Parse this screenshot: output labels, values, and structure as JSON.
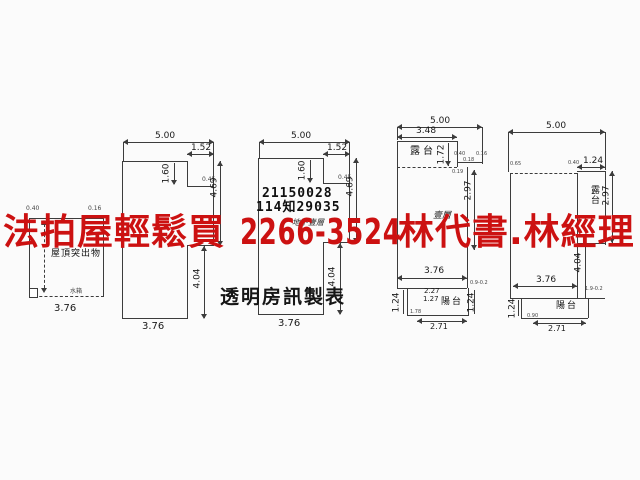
{
  "watermark": {
    "text_left": "法拍屋輕鬆買",
    "text_phone": "2266-3524",
    "text_right": "林代書.林經理",
    "color": "#cc1111"
  },
  "stamp": {
    "serial_1": "21150028",
    "serial_2": "114知29035",
    "publisher": "透明房訊製表"
  },
  "plans": {
    "p1": {
      "label": "屋頂突出物",
      "dim_bottom": "3.76",
      "tiny_top_left": "0.40",
      "tiny_top_right": "0.16",
      "tiny_bottom": "水箱"
    },
    "p2": {
      "dim_top": "5.00",
      "dim_step_w": "1.52",
      "dim_step_h": "1.60",
      "dim_right_upper": "4.69",
      "dim_right_lower": "4.04",
      "dim_bottom": "3.76",
      "tiny_step": "0.45"
    },
    "p3": {
      "floor_label": "地下壹層",
      "dim_top": "5.00",
      "dim_step_w": "1.52",
      "dim_step_h": "1.60",
      "dim_right_upper": "4.69",
      "dim_right_lower": "4.04",
      "dim_bottom": "3.76",
      "tiny_step": "0.45"
    },
    "p4": {
      "floor_label": "壹層",
      "terrace_label": "露台",
      "balcony_label": "陽台",
      "dim_top": "5.00",
      "dim_terrace_w": "3.48",
      "dim_terrace_h": "1.72",
      "dim_right": "2.97",
      "dim_width": "3.76",
      "dim_balcony_left": "1.24",
      "dim_balcony_right": "1.24",
      "dim_balcony_w1": "2.27",
      "dim_balcony_w2": "1.27",
      "dim_balcony_bottom": "2.71",
      "tiny_a": "0.40",
      "tiny_b": "0.18",
      "tiny_c": "0.16",
      "tiny_d": "0.19",
      "tiny_e": "1.78",
      "tiny_f": "0.9-0.2"
    },
    "p5": {
      "terrace_label": "露台",
      "balcony_label": "陽台",
      "dim_top": "5.00",
      "dim_terrace_w": "1.24",
      "dim_right": "2.97",
      "dim_right_lower": "4.04",
      "dim_width": "3.76",
      "dim_balcony_left": "1.24",
      "dim_balcony_bottom": "2.71",
      "tiny_top_left": "0.65",
      "tiny_top_right": "0.40",
      "tiny_bottom_left": "0.90",
      "tiny_bottom_right": "1.9-0.2"
    }
  }
}
